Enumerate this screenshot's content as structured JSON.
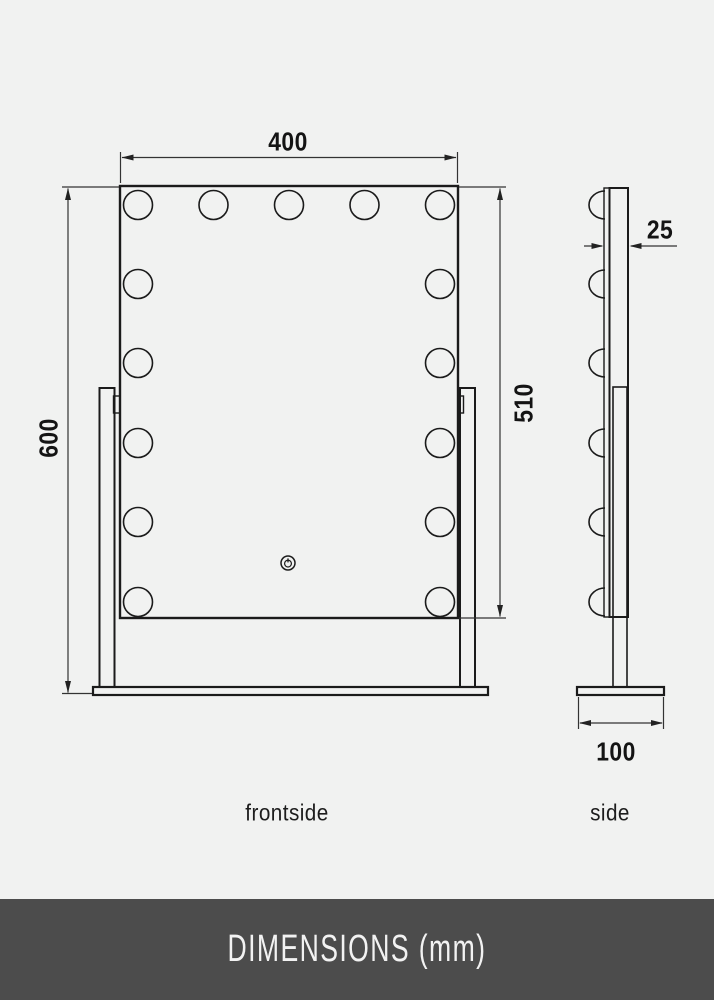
{
  "page": {
    "background_color": "#f1f2f1",
    "line_color": "#1b1b1b",
    "dimension_line_color": "#333333"
  },
  "dimensions": {
    "mirror_width": "400",
    "total_height": "600",
    "mirror_height": "510",
    "depth": "25",
    "base_depth": "100"
  },
  "views": {
    "front_label": "frontside",
    "side_label": "side"
  },
  "drawing": {
    "bulbs_top_row": 5,
    "bulbs_left_column": 6,
    "bulbs_right_column": 6,
    "bulbs_side_view": 6,
    "touch_icon": "power-icon"
  },
  "footer": {
    "title": "DIMENSIONS (mm)",
    "background_color": "#4c4c4c",
    "text_color": "#f2f2f2"
  }
}
